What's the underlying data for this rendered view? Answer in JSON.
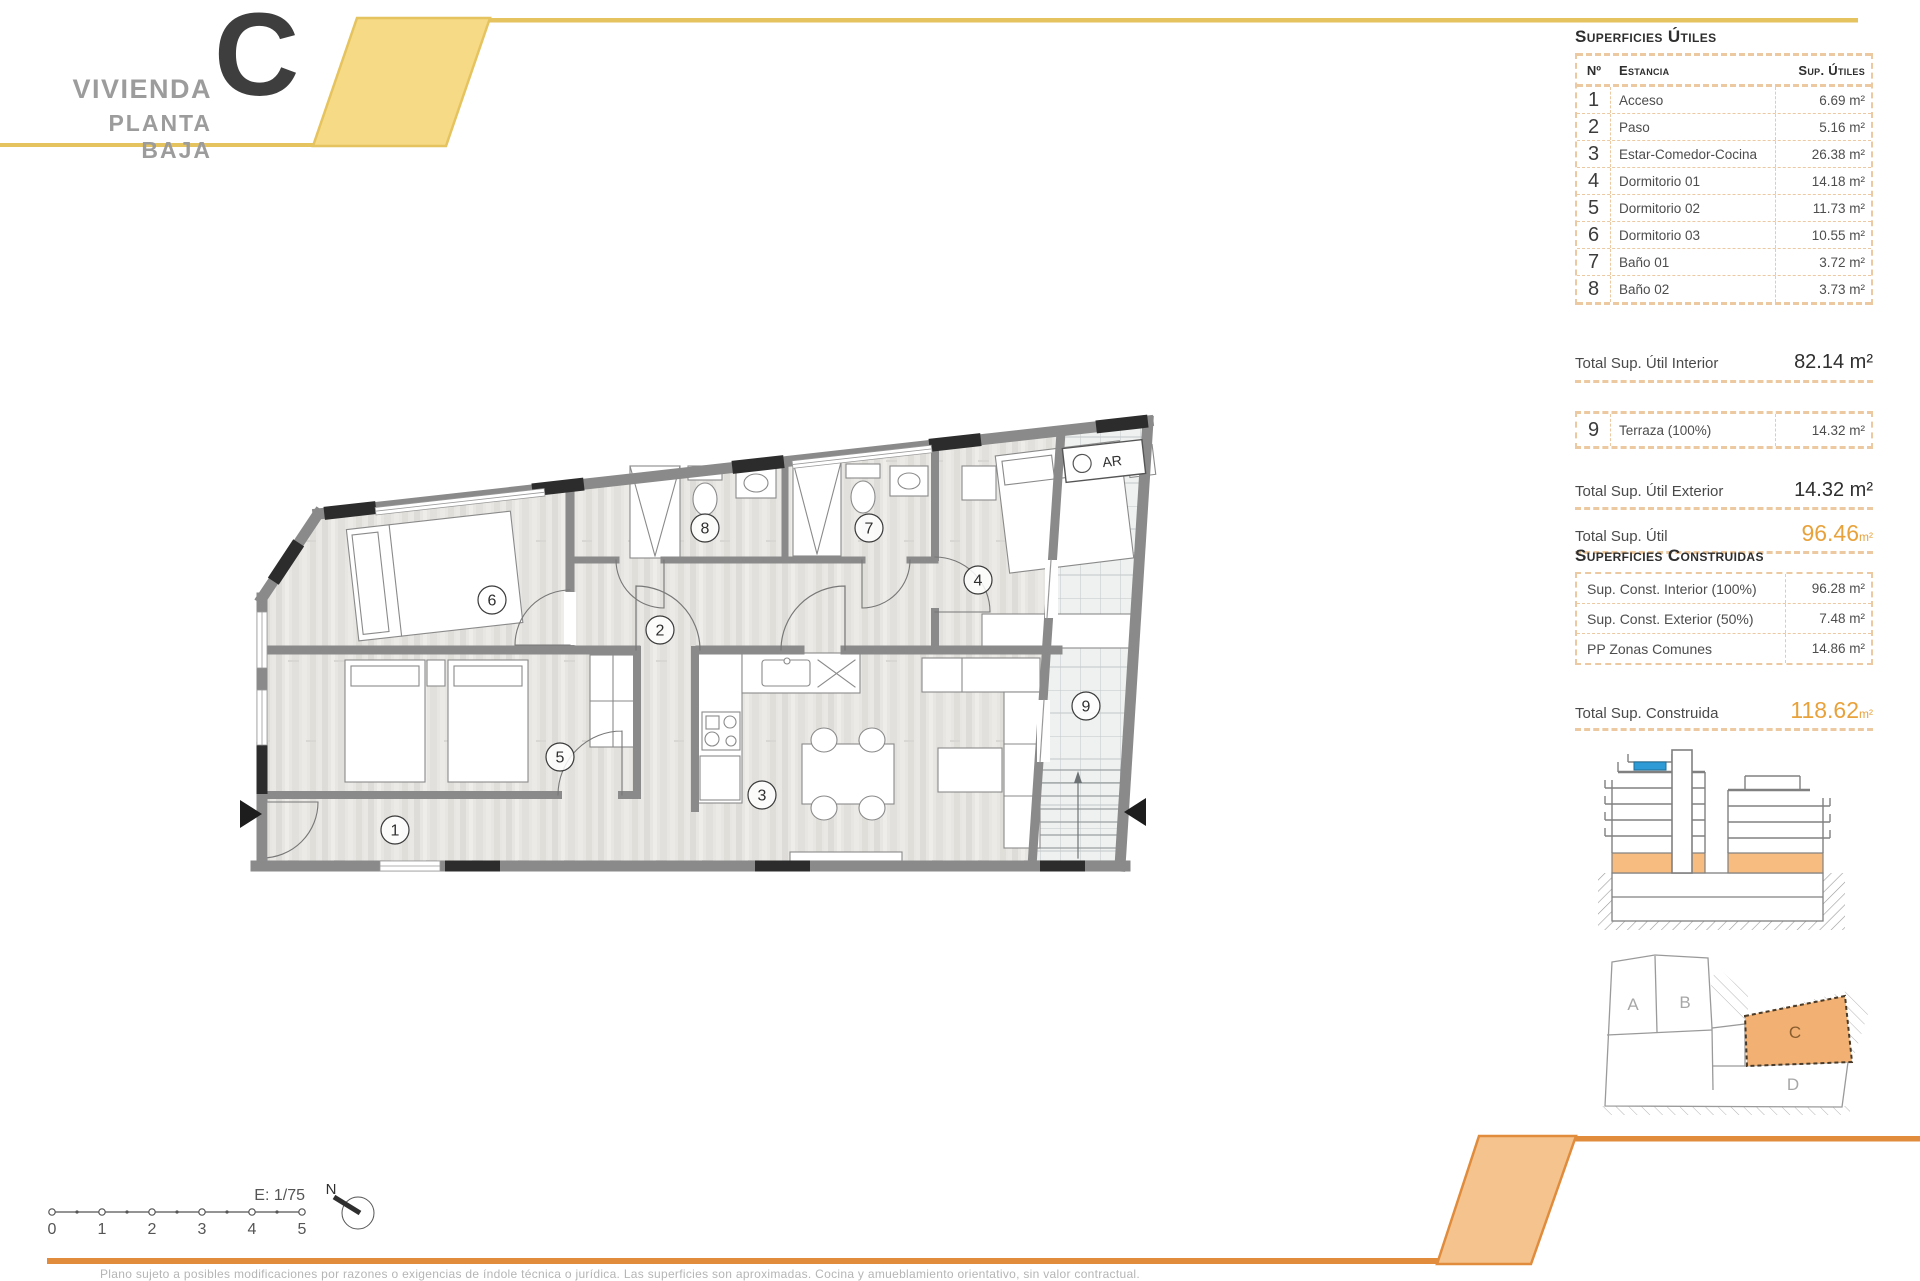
{
  "header": {
    "title": "VIVIENDA",
    "subtitle": "PLANTA BAJA",
    "unit_letter": "C"
  },
  "surfaces_utiles": {
    "section_title": "Superficies Útiles",
    "col_no": "Nº",
    "col_room": "Estancia",
    "col_area": "Sup. Útiles",
    "rows": [
      {
        "no": "1",
        "name": "Acceso",
        "area": "6.69 m²"
      },
      {
        "no": "2",
        "name": "Paso",
        "area": "5.16 m²"
      },
      {
        "no": "3",
        "name": "Estar-Comedor-Cocina",
        "area": "26.38 m²"
      },
      {
        "no": "4",
        "name": "Dormitorio 01",
        "area": "14.18 m²"
      },
      {
        "no": "5",
        "name": "Dormitorio 02",
        "area": "11.73 m²"
      },
      {
        "no": "6",
        "name": "Dormitorio 03",
        "area": "10.55 m²"
      },
      {
        "no": "7",
        "name": "Baño 01",
        "area": "3.72 m²"
      },
      {
        "no": "8",
        "name": "Baño 02",
        "area": "3.73 m²"
      }
    ],
    "total_interior_label": "Total Sup. Útil Interior",
    "total_interior_value": "82.14 m²",
    "terraza_row": {
      "no": "9",
      "name": "Terraza (100%)",
      "area": "14.32 m²"
    },
    "total_exterior_label": "Total Sup. Útil Exterior",
    "total_exterior_value": "14.32 m²",
    "total_label": "Total Sup. Útil",
    "total_value": "96.46",
    "total_unit": "m²"
  },
  "surfaces_construidas": {
    "section_title": "Superficies Construidas",
    "rows": [
      {
        "name": "Sup. Const. Interior (100%)",
        "area": "96.28 m²"
      },
      {
        "name": "Sup. Const. Exterior (50%)",
        "area": "7.48 m²"
      },
      {
        "name": "PP Zonas Comunes",
        "area": "14.86 m²"
      }
    ],
    "total_label": "Total Sup. Construida",
    "total_value": "118.62",
    "total_unit": "m²"
  },
  "plan": {
    "room_numbers": [
      "1",
      "2",
      "3",
      "4",
      "5",
      "6",
      "7",
      "8",
      "9"
    ],
    "room_names": [
      "Acceso",
      "Paso",
      "Estar-Comedor-Cocina",
      "Dormitorio 01",
      "Dormitorio 02",
      "Dormitorio 03",
      "Baño 01",
      "Baño 02",
      "Terraza"
    ],
    "ar_label": "AR"
  },
  "site_plan": {
    "units": [
      "A",
      "B",
      "C",
      "D"
    ],
    "highlighted_unit": "C"
  },
  "scale_bar": {
    "scale_label": "E: 1/75",
    "ticks": [
      "0",
      "1",
      "2",
      "3",
      "4",
      "5"
    ],
    "north_label": "N"
  },
  "footer": {
    "disclaimer": "Plano sujeto a posibles modificaciones por razones o exigencias de índole técnica o jurídica. Las superficies son aproximadas. Cocina y amueblamiento orientativo, sin valor contractual."
  },
  "colors": {
    "accent_orange": "#e8a23b",
    "footer_orange": "#e08c3c",
    "footer_band_fill": "#f5c38d",
    "header_yellow": "#e5c35f",
    "header_band_fill": "#f6da85",
    "dashed_border": "#ecc9a0",
    "wall_gray": "#8a8a8a",
    "pier_black": "#2c2c2c",
    "section_ground_floor_orange": "#f7bc80",
    "section_highlight_blue": "#2e9bd6",
    "site_unit_c_fill": "#f2b172"
  }
}
